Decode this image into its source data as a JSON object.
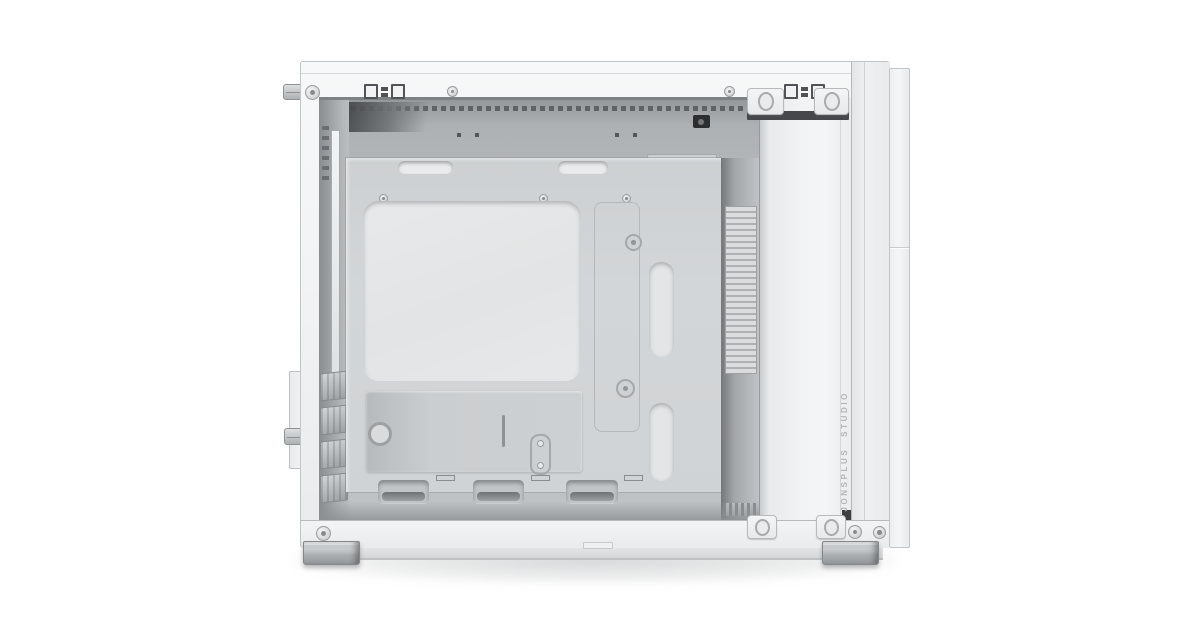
{
  "product": {
    "branding_text": "JONSPLUS STUDIO"
  },
  "colors": {
    "background": "#ffffff",
    "case_face": "#f2f3f4",
    "case_face_dark": "#e9ebec",
    "case_edge": "#c3c6c8",
    "interior": "#b7babd",
    "interior_shadow": "#8c8f92",
    "tray": "#d3d6d8",
    "cutout": "#e2e4e5",
    "recess": "#9fa2a5",
    "dark_accent": "#45474a",
    "brand_text": "#b2b5b8",
    "foot": "#aaadaf",
    "floor_shadow": "rgba(96,100,104,0.25)"
  }
}
